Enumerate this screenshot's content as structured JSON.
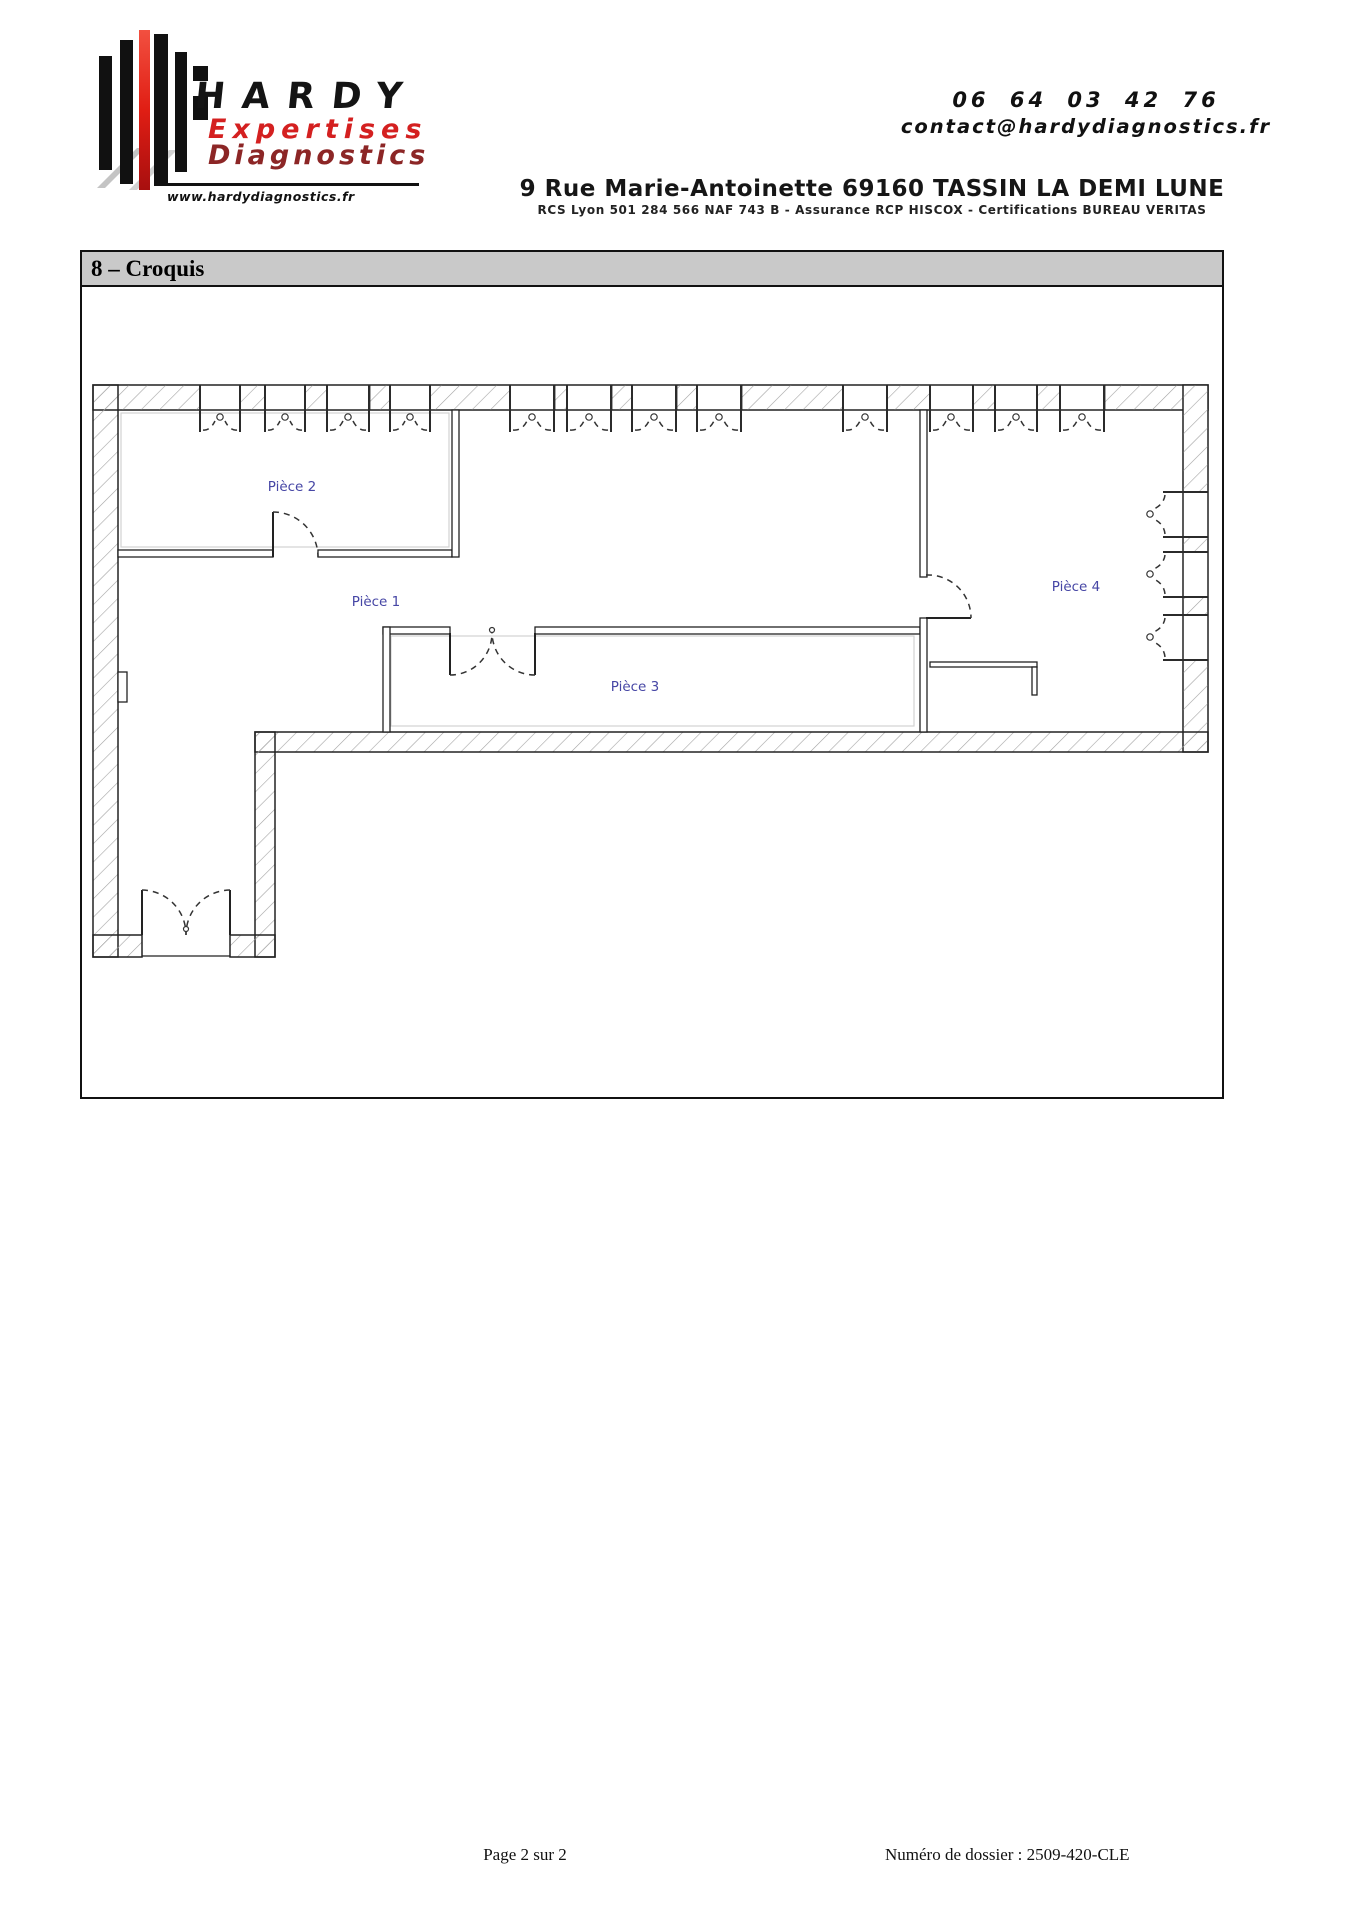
{
  "header": {
    "logo": {
      "brand": "HARDY",
      "line1": "Expertises",
      "line2": "Diagnostics",
      "website": "www.hardydiagnostics.fr",
      "brand_color": "#141414",
      "line1_color": "#d42020",
      "line2_color": "#8c2626"
    },
    "contact": {
      "phone": "06 64 03 42 76",
      "email": "contact@hardydiagnostics.fr"
    },
    "address": "9 Rue Marie-Antoinette 69160 TASSIN LA DEMI LUNE",
    "legal": "RCS Lyon 501 284 566 NAF 743 B - Assurance RCP HISCOX - Certifications BUREAU VERITAS"
  },
  "section": {
    "title": "8 – Croquis"
  },
  "floorplan": {
    "label_color": "#4646a5",
    "rooms": [
      {
        "label": "Pièce 1"
      },
      {
        "label": "Pièce 2"
      },
      {
        "label": "Pièce 3"
      },
      {
        "label": "Pièce 4"
      }
    ]
  },
  "footer": {
    "page": "Page 2 sur 2",
    "dossier": "Numéro de dossier : 2509-420-CLE"
  }
}
